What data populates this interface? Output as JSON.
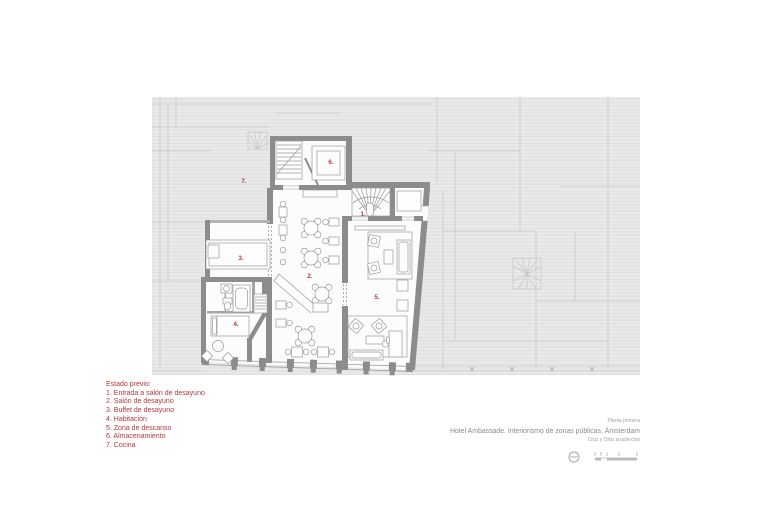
{
  "plan": {
    "room_labels": [
      "1.",
      "2.",
      "3.",
      "4.",
      "5.",
      "6.",
      "7."
    ],
    "colors": {
      "accent_red": "#b5373a",
      "wall_gray": "#8c8c8c",
      "context_fill": "#e9e9e9",
      "context_hatch_line": "#dcdcdc",
      "context_outline": "#c9c9c9",
      "furniture_line": "#9a9a9a",
      "room_fill": "#fcfcfc"
    }
  },
  "legend": {
    "title": "Estado previo:",
    "items": [
      "1. Entrada a salón de desayuno",
      "2. Salón de desayuno",
      "3. Buffet de desayuno",
      "4. Habitación",
      "5. Zona de descanso",
      "6. Almacenamiento",
      "7. Cocina"
    ]
  },
  "titleblock": {
    "sheet": "Planta primera",
    "title": "Hotel Ambassade. Interiorismo de zonas públicas, Ámsterdam",
    "architects": "Cruz y Ortiz arquitectos",
    "scale_labels": [
      "0",
      "5",
      "1",
      "2",
      "5"
    ]
  }
}
